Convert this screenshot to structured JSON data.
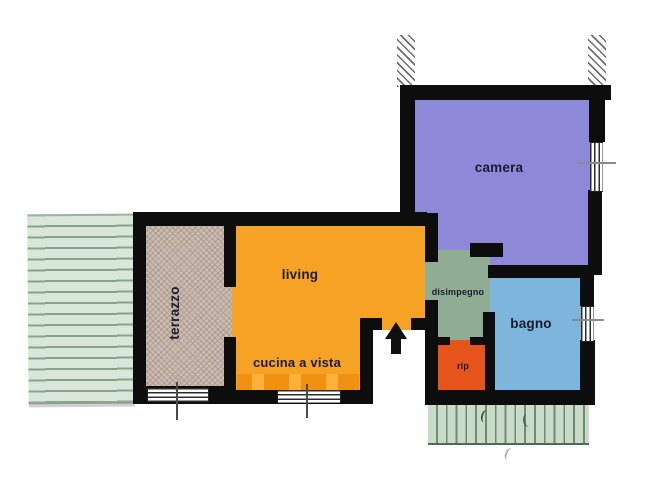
{
  "plan": {
    "name": "apartment-floor-plan",
    "rooms": {
      "camera": {
        "label": "camera",
        "color": "#8d89d8"
      },
      "living": {
        "label": "living",
        "color": "#f6a325"
      },
      "cucina": {
        "label": "cucina a vista",
        "color": "#f6a325"
      },
      "terrazzo": {
        "label": "terrazzo",
        "color": "#c9bbb1"
      },
      "disimpegno": {
        "label": "disimpegno",
        "color": "#8fad92"
      },
      "bagno": {
        "label": "bagno",
        "color": "#7db5dd"
      },
      "rip": {
        "label": "rip",
        "color": "#e5541b"
      }
    },
    "palette": {
      "wall": "#0d0d0d",
      "garden_left": "#d9e7da",
      "garden_bottom": "#c8dcc9",
      "counter": "#f19110",
      "window_axis_line": "#8a8a8a",
      "hatch_line": "#6e6e6e"
    }
  }
}
